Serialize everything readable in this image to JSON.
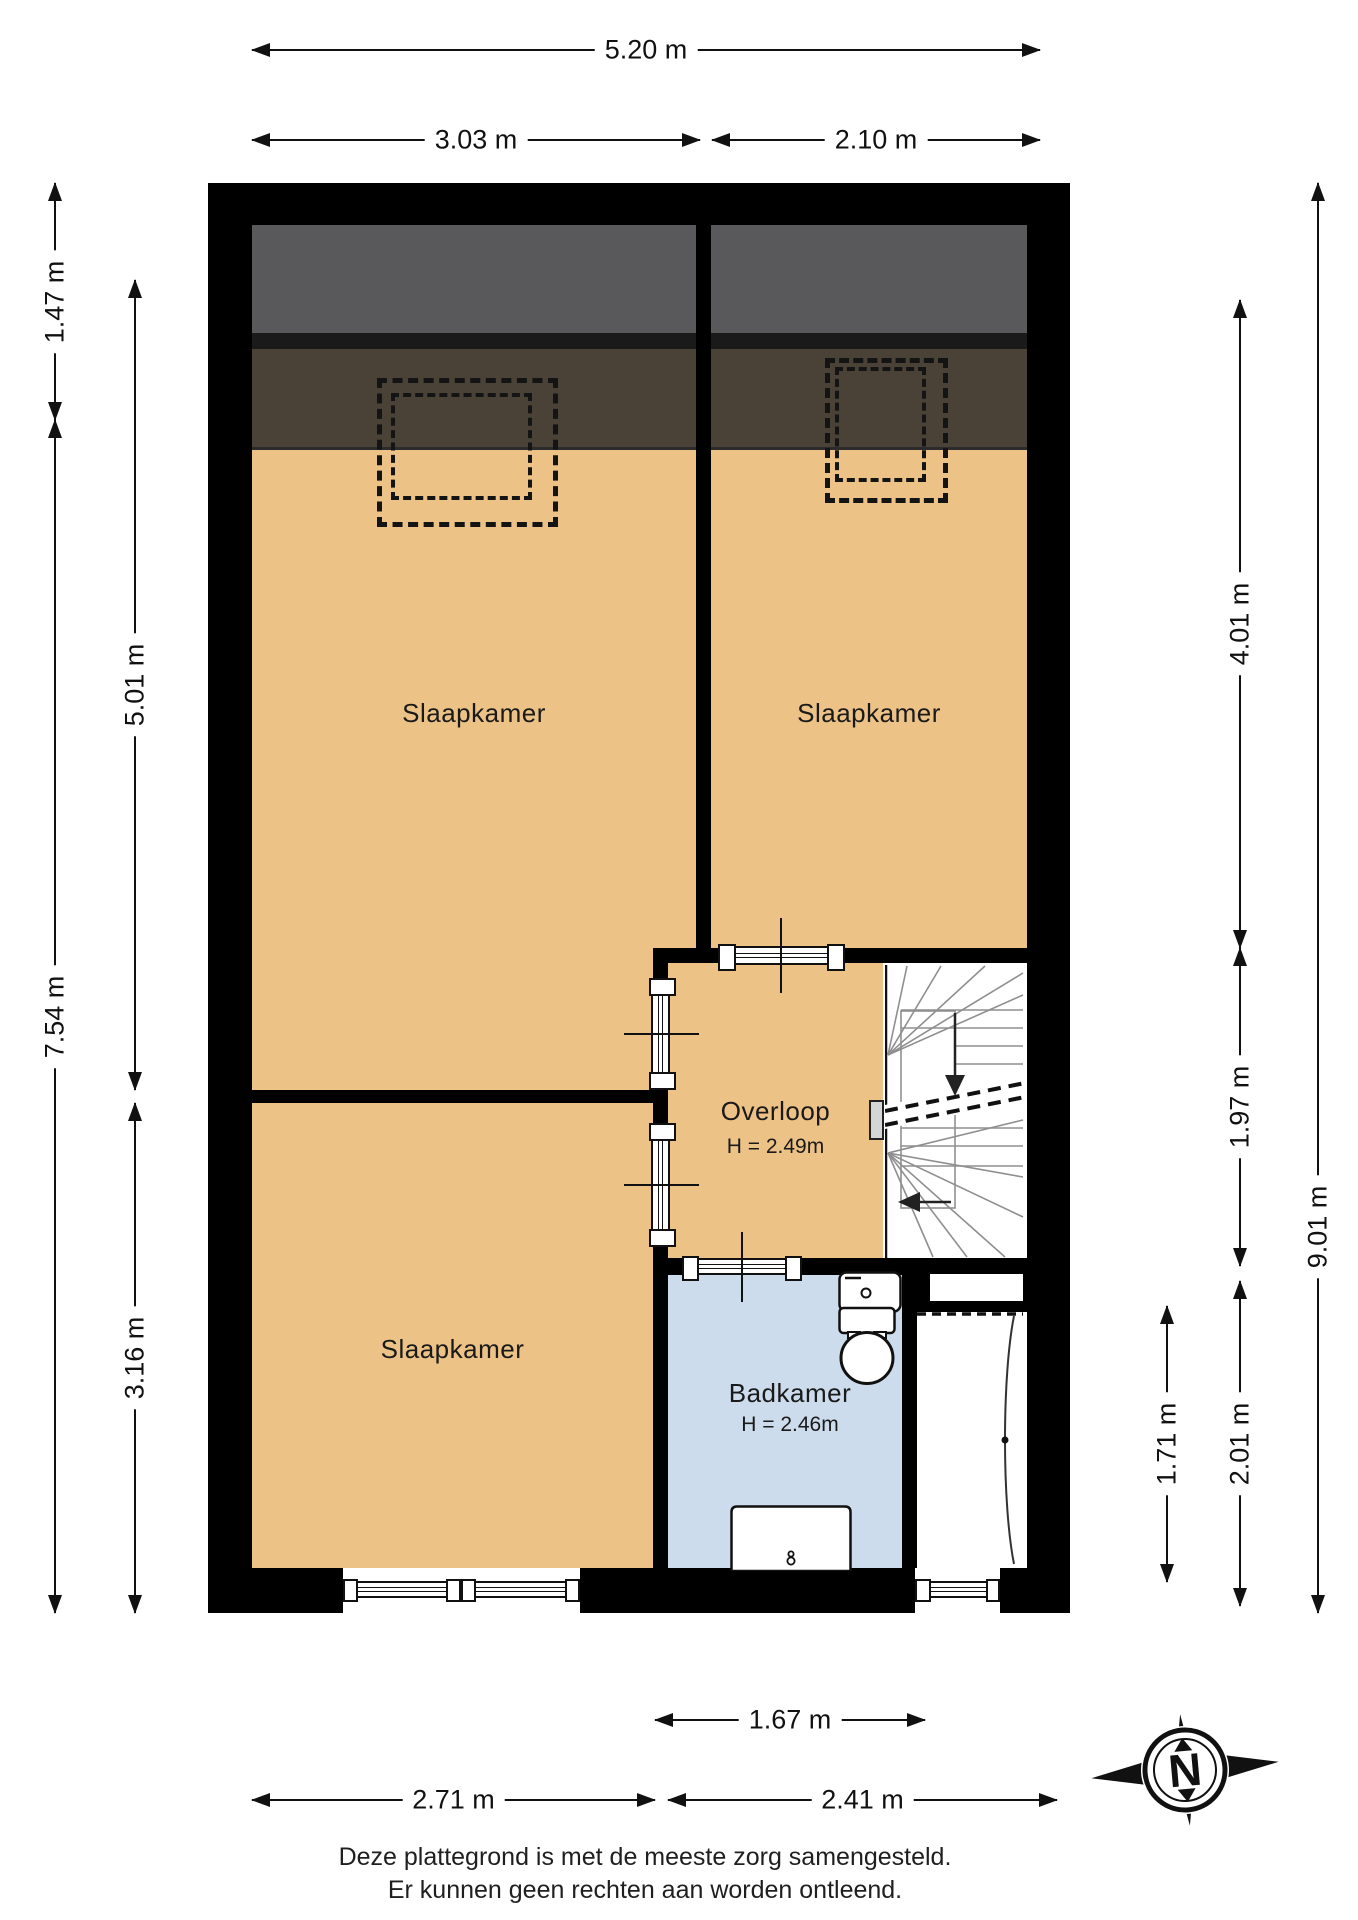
{
  "plan_title": "Eerste verdieping plattegrond",
  "rooms": {
    "bedroom_top_left": {
      "label": "Slaapkamer"
    },
    "bedroom_top_right": {
      "label": "Slaapkamer"
    },
    "bedroom_bottom": {
      "label": "Slaapkamer"
    },
    "landing": {
      "label": "Overloop",
      "ceiling_height": "H = 2.49m"
    },
    "bathroom": {
      "label": "Badkamer",
      "ceiling_height": "H = 2.46m"
    }
  },
  "dimensions": {
    "top_total": "5.20 m",
    "top_left": "3.03 m",
    "top_right": "2.10 m",
    "left_outer_top": "1.47 m",
    "left_outer_bottom": "7.54 m",
    "left_inner_top": "5.01 m",
    "left_inner_bottom": "3.16 m",
    "right_inner_top": "4.01 m",
    "right_inner_mid": "1.97 m",
    "right_inner_bottom": "2.01 m",
    "right_bath_side": "1.71 m",
    "right_outer": "9.01 m",
    "bottom_bath": "1.67 m",
    "bottom_left": "2.71 m",
    "bottom_right": "2.41 m"
  },
  "compass": {
    "north_label": "N"
  },
  "footer": {
    "line1": "Deze plattegrond is met de meeste zorg samengesteld.",
    "line2": "Er kunnen geen rechten aan worden ontleend."
  },
  "colors": {
    "wall": "#000000",
    "floor_orange": "#ecc287",
    "bathroom_blue": "#ccdcec",
    "roof_gray": "#59595b",
    "roof_brown": "#4a4236",
    "stair_line_gray": "#999999"
  }
}
